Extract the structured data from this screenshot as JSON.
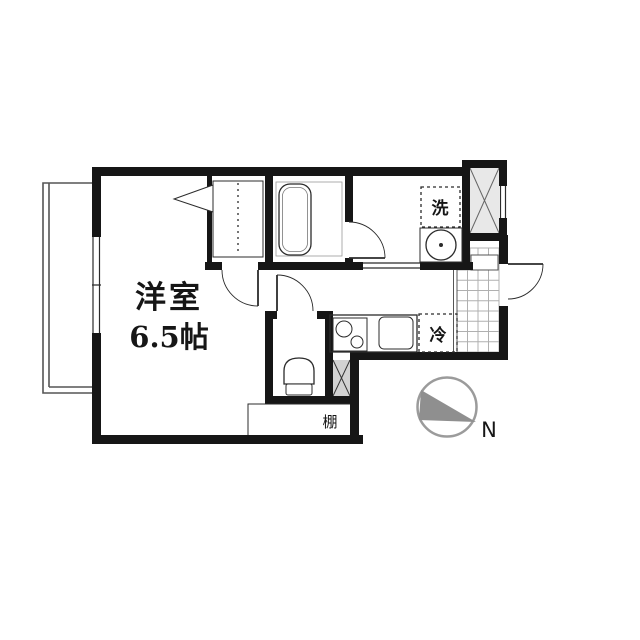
{
  "floor_plan": {
    "room_label": "洋室",
    "room_size": "6.5帖",
    "washer_label": "洗",
    "fridge_label": "冷",
    "shelf_label": "棚",
    "north_label": "N",
    "colors": {
      "wall": "#161616",
      "line": "#2b2b2b",
      "soft_line": "#555555",
      "light_line": "#999999",
      "tile_line": "#b0b0b0",
      "shaft_fill": "#e8e8e8",
      "dead_fill": "#d2d2d2",
      "compass": "#9b9b9b",
      "compass_arrow": "#8f8f8f",
      "background": "#ffffff"
    }
  }
}
